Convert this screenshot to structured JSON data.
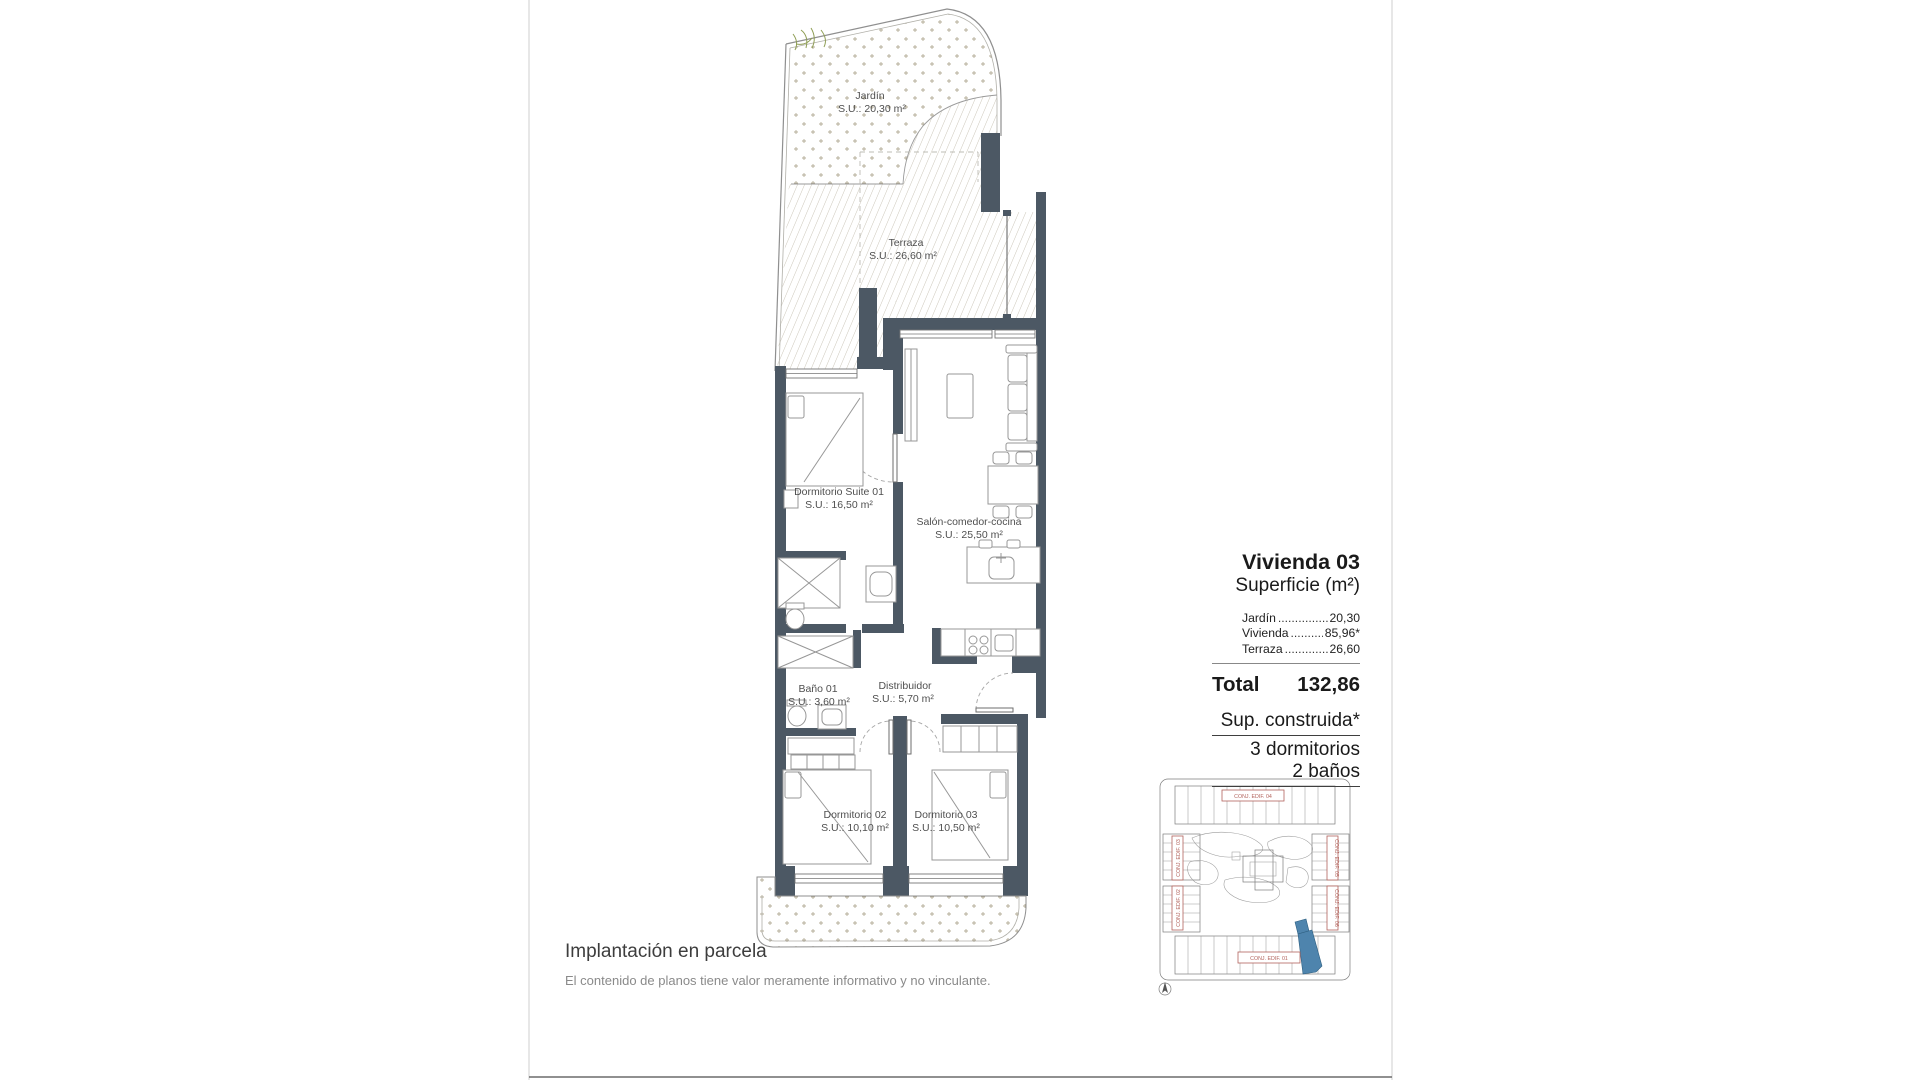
{
  "page": {
    "background": "#ffffff"
  },
  "colors": {
    "wall": "#4c5864",
    "terrace_hatch": "#ccc7ba",
    "garden_dots": "#b4ac97",
    "site_highlight": "#4e84ad",
    "site_label_red": "#b2635c"
  },
  "floor_plan": {
    "rooms": {
      "jardin": {
        "name": "Jardín",
        "area": "S.U.: 20,30 m²"
      },
      "terraza": {
        "name": "Terraza",
        "area": "S.U.: 26,60 m²"
      },
      "suite": {
        "name": "Dormitorio Suite 01",
        "area": "S.U.: 16,50 m²"
      },
      "salon": {
        "name": "Salón-comedor-cocina",
        "area": "S.U.: 25,50 m²"
      },
      "bano": {
        "name": "Baño 01",
        "area": "S.U.: 3,60 m²"
      },
      "distribuidor": {
        "name": "Distribuidor",
        "area": "S.U.: 5,70 m²"
      },
      "dorm02": {
        "name": "Dormitorio 02",
        "area": "S.U.: 10,10 m²"
      },
      "dorm03": {
        "name": "Dormitorio 03",
        "area": "S.U.: 10,50 m²"
      }
    }
  },
  "panel": {
    "title": "Vivienda 03",
    "subtitle": "Superficie (m²)",
    "rows": [
      {
        "label": "Jardín",
        "dots": "...............",
        "value": "20,30"
      },
      {
        "label": "Vivienda",
        "dots": "..........",
        "value": "85,96*"
      },
      {
        "label": "Terraza",
        "dots": "..............",
        "value": "26,60"
      }
    ],
    "total_label": "Total",
    "total_value": "132,86",
    "notes": {
      "construida": "Sup. construida*",
      "dormitorios": "3 dormitorios",
      "banos": "2 baños"
    }
  },
  "site_plan": {
    "labels": {
      "edif04": "CONJ. EDIF. 04",
      "edif03": "CONJ. EDIF. 03",
      "edif02": "CONJ. EDIF. 02",
      "edif05": "CONJ. EDIF. 05",
      "edif06": "CONJ. EDIF. 06",
      "edif01": "CONJ. EDIF. 01"
    },
    "highlight_color": "#4e84ad"
  },
  "footer": {
    "title": "Implantación en parcela",
    "disclaimer": "El contenido de planos tiene valor meramente informativo y no vinculante."
  }
}
